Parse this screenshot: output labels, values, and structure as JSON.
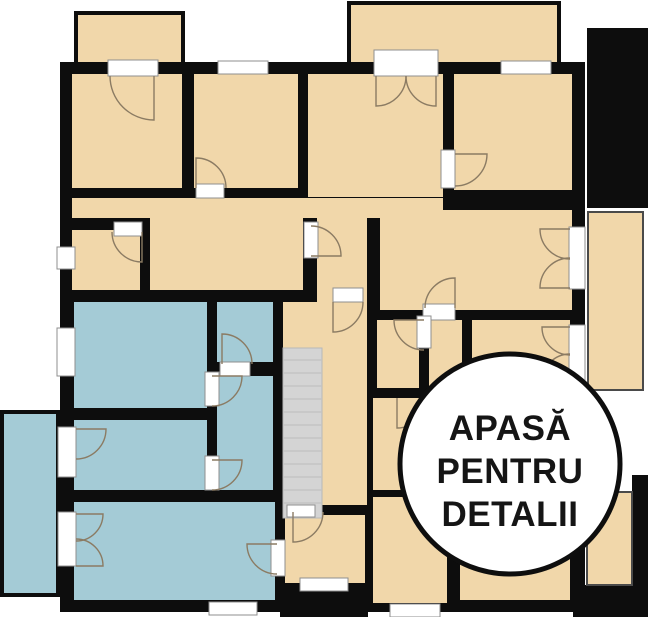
{
  "cta": {
    "line1": "APASĂ",
    "line2": "PENTRU",
    "line3": "DETALII"
  },
  "palette": {
    "background": "#ffffff",
    "wall": "#0d0d0d",
    "room_warm": "#f1d7aa",
    "room_cool": "#a4cbd6",
    "stairs": "#d4d4d4",
    "window": "#ffffff",
    "door_arc": "#8b7b63",
    "circle_bg": "#ffffff",
    "circle_border": "#0e0e0e",
    "text": "#151515"
  }
}
